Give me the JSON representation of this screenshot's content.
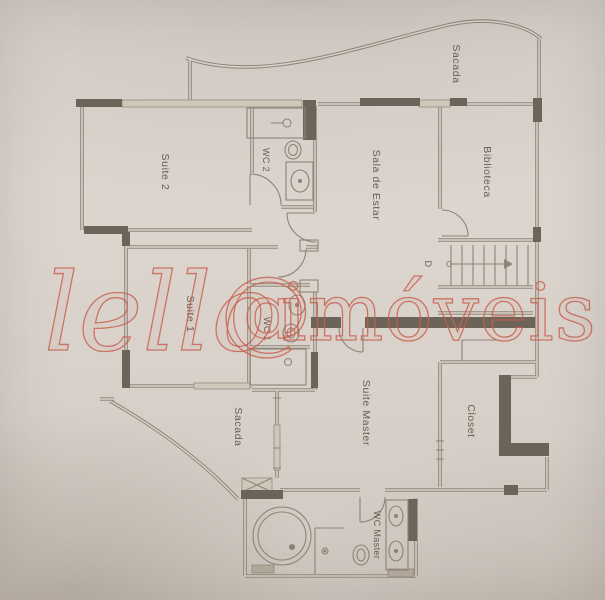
{
  "palette": {
    "paper": "#d9d2ca",
    "paper_dark": "#cdc5bc",
    "wall_line": "#8d8478",
    "wall_dark": "#6d6459",
    "window_fill": "#cfc7ba",
    "watermark_red": "#c75f4f",
    "label_color": "#655e52"
  },
  "watermark": {
    "script": "lello",
    "symbol": "@",
    "brand": "imóveis"
  },
  "rooms": {
    "sacada_top": "Sacada",
    "suite2": "Suite 2",
    "wc2": "WC 2",
    "sala_de_estar": "Sala de Estar",
    "biblioteca": "Biblioteca",
    "suite1": "Suite 1",
    "wc1": "WC 1",
    "sacada_lower": "Sacada",
    "suite_master": "Suite Master",
    "closet": "Closet",
    "wc_master": "WC Master"
  },
  "stairs": {
    "label": "D"
  }
}
